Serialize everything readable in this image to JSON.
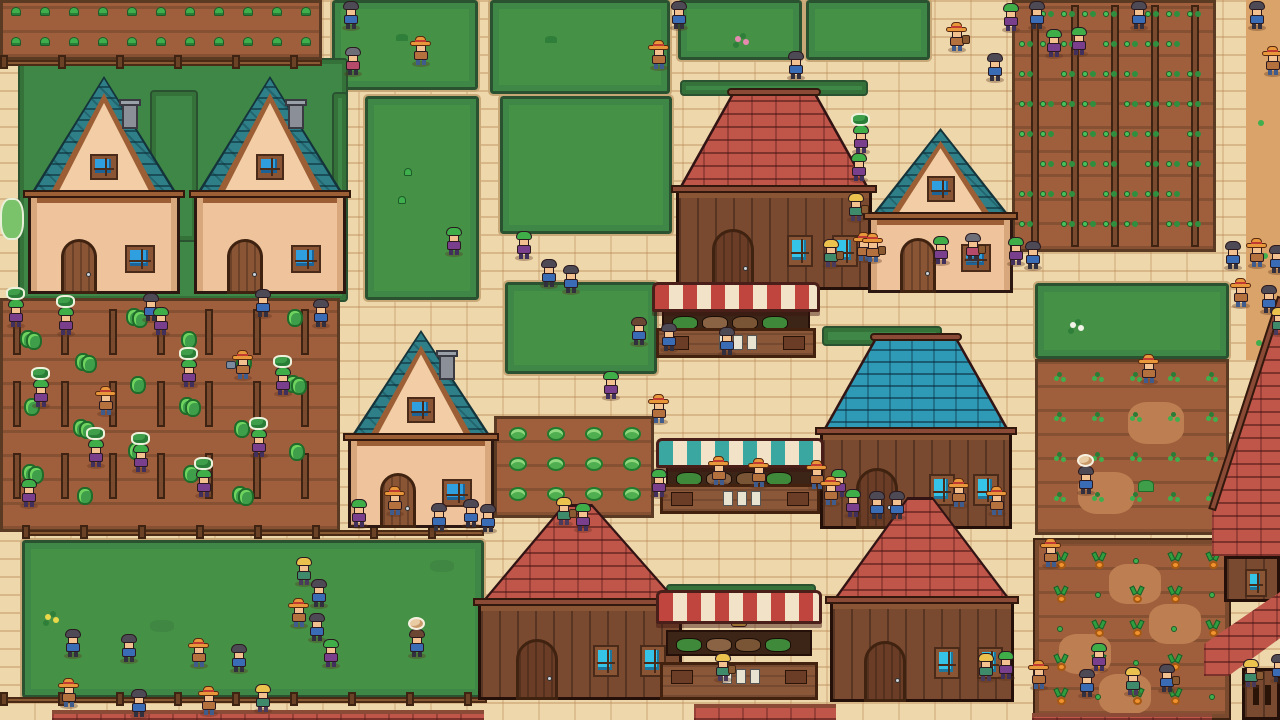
{
  "scene": {
    "width": 1280,
    "height": 720,
    "kind": "pixel-art-farming-village"
  },
  "palette": {
    "path": "#eed7ab",
    "path_line": "#d8b787",
    "dirt": "#d9a369",
    "grass": "#459247",
    "grass_edge": "#2a5230",
    "hedge": "#3f8746",
    "soil": "#a05f3c",
    "soil_light": "#bd7f52",
    "soil_border": "#5a3a22",
    "roof_teal": "#2e7f88",
    "roof_red": "#c0554a",
    "roof_blue": "#2f9ab5",
    "roof_trim": "#9c5f35",
    "ridge": "#8a4a35",
    "wall_peach": "#efc49c",
    "wall_wood": "#7a4a30",
    "door": "#8a5535",
    "door_dark": "#6b3d26",
    "glass_blue": "#2f9fe0",
    "glass_teal": "#35c4e8",
    "awning_red": "#c0453f",
    "awning_teal": "#3aa7a0",
    "awning_cream": "#f2e3c8",
    "stall_wood": "#8a5738",
    "stall_dark": "#3c2517",
    "fence": "#8a5a35",
    "fence_post": "#6b4226",
    "leaf": "#3fae4c",
    "leaf_dark": "#2a7d36",
    "carrot": "#f0922e",
    "chimney": "#8a8f98",
    "villagers": {
      "straw": {
        "hat": "#e8973a",
        "band": "#c23b32",
        "shirt": "#b5713d",
        "pants": "#3f5c8c"
      },
      "green": {
        "hair": "#3fae49",
        "shirt": "#7a3f8c",
        "pants": "#42305c"
      },
      "dark": {
        "hair": "#4e4a55",
        "shirt": "#3a6bb5",
        "pants": "#32303e"
      },
      "gray": {
        "hair": "#6e6e78",
        "shirt": "#b54a6b",
        "pants": "#32303e"
      },
      "blonde": {
        "hair": "#ecc24e",
        "shirt": "#3f8a6b",
        "pants": "#4a3a5c"
      },
      "brown": {
        "hair": "#6b4632",
        "shirt": "#3a6bb5",
        "pants": "#32303e"
      }
    }
  },
  "ground": {
    "dirt_strip": {
      "x": 1246,
      "y": 0,
      "w": 34,
      "h": 360
    },
    "dirt_dots": [
      [
        1258,
        120
      ],
      [
        1262,
        253
      ],
      [
        1256,
        340
      ]
    ]
  },
  "grass_plots": [
    {
      "x": 332,
      "y": 0,
      "w": 146,
      "h": 90
    },
    {
      "x": 490,
      "y": 0,
      "w": 180,
      "h": 94
    },
    {
      "x": 678,
      "y": 0,
      "w": 124,
      "h": 60
    },
    {
      "x": 806,
      "y": 0,
      "w": 124,
      "h": 60
    },
    {
      "x": 365,
      "y": 96,
      "w": 114,
      "h": 204
    },
    {
      "x": 500,
      "y": 96,
      "w": 172,
      "h": 138
    },
    {
      "x": 505,
      "y": 282,
      "w": 152,
      "h": 92
    },
    {
      "x": 22,
      "y": 540,
      "w": 462,
      "h": 158
    },
    {
      "x": 1035,
      "y": 283,
      "w": 194,
      "h": 76
    }
  ],
  "hedges": [
    {
      "x": 18,
      "y": 58,
      "w": 330,
      "h": 244
    },
    {
      "x": 150,
      "y": 90,
      "w": 48,
      "h": 152
    },
    {
      "x": 332,
      "y": 92,
      "w": 16,
      "h": 160
    },
    {
      "x": 680,
      "y": 80,
      "w": 188,
      "h": 16
    },
    {
      "x": 822,
      "y": 326,
      "w": 120,
      "h": 20
    },
    {
      "x": 666,
      "y": 584,
      "w": 150,
      "h": 26
    }
  ],
  "bushes": [
    {
      "x": 0,
      "y": 198,
      "w": 24,
      "h": 42
    }
  ],
  "fields": [
    {
      "type": "seedlings",
      "x": 0,
      "y": 0,
      "w": 322,
      "h": 60
    },
    {
      "type": "trellis",
      "x": 0,
      "y": 298,
      "w": 340,
      "h": 234
    },
    {
      "type": "beans",
      "x": 1012,
      "y": 0,
      "w": 204,
      "h": 252
    },
    {
      "type": "sprouts",
      "x": 1035,
      "y": 359,
      "w": 194,
      "h": 176
    },
    {
      "type": "carrots",
      "x": 1035,
      "y": 540,
      "w": 194,
      "h": 178
    },
    {
      "type": "cabbage",
      "x": 494,
      "y": 416,
      "w": 160,
      "h": 102
    }
  ],
  "fences": [
    {
      "x": 0,
      "y": 60,
      "w": 322
    },
    {
      "x": 22,
      "y": 530,
      "w": 462
    },
    {
      "x": 0,
      "y": 697,
      "w": 487
    }
  ],
  "roof_strips": [
    {
      "x": 52,
      "y": 710,
      "w": 432,
      "h": 10
    },
    {
      "x": 694,
      "y": 704,
      "w": 142,
      "h": 16
    },
    {
      "x": 1032,
      "y": 713,
      "w": 180,
      "h": 7
    }
  ],
  "buildings": [
    {
      "type": "house",
      "roof": "teal",
      "x": 28,
      "y": 76,
      "w": 152,
      "h": 218,
      "chimney": true
    },
    {
      "type": "house",
      "roof": "teal",
      "x": 194,
      "y": 76,
      "w": 152,
      "h": 218,
      "chimney": true
    },
    {
      "type": "barn",
      "roof": "red",
      "x": 676,
      "y": 88,
      "w": 196,
      "h": 202,
      "flat": true
    },
    {
      "type": "house",
      "roof": "teal",
      "x": 868,
      "y": 128,
      "w": 145,
      "h": 165,
      "chimney": false
    },
    {
      "type": "house",
      "roof": "teal",
      "x": 348,
      "y": 330,
      "w": 146,
      "h": 198,
      "chimney": true
    },
    {
      "type": "barn",
      "roof": "blue",
      "x": 820,
      "y": 333,
      "w": 192,
      "h": 196,
      "flat": true
    },
    {
      "type": "barn",
      "roof": "red",
      "x": 478,
      "y": 504,
      "w": 204,
      "h": 196,
      "flat": false
    },
    {
      "type": "barn",
      "roof": "red",
      "x": 830,
      "y": 497,
      "w": 184,
      "h": 205,
      "flat": false
    },
    {
      "type": "edge-right",
      "x": 1212,
      "y": 298,
      "w": 68,
      "h": 302
    },
    {
      "type": "edge-corner",
      "x": 1204,
      "y": 592,
      "w": 76,
      "h": 128
    }
  ],
  "stalls": [
    {
      "x": 656,
      "y": 282,
      "w": 160,
      "h": 76,
      "awning": "red",
      "keeper": "straw"
    },
    {
      "x": 660,
      "y": 438,
      "w": 160,
      "h": 76,
      "awning": "teal",
      "keeper": "blonde"
    },
    {
      "x": 660,
      "y": 590,
      "w": 158,
      "h": 110,
      "awning": "red",
      "keeper": "blonde"
    }
  ],
  "decor": [
    {
      "x": 396,
      "y": 34,
      "k": "tuft"
    },
    {
      "x": 735,
      "y": 36,
      "k": "flower-pink"
    },
    {
      "x": 404,
      "y": 168,
      "k": "sprout"
    },
    {
      "x": 398,
      "y": 196,
      "k": "sprout"
    },
    {
      "x": 545,
      "y": 36,
      "k": "tuft"
    },
    {
      "x": 45,
      "y": 614,
      "k": "flower-yellow"
    },
    {
      "x": 150,
      "y": 620,
      "k": "patch"
    },
    {
      "x": 430,
      "y": 560,
      "k": "patch"
    },
    {
      "x": 1070,
      "y": 322,
      "k": "flower-white"
    }
  ],
  "villagers": [
    [
      340,
      0,
      "dark"
    ],
    [
      342,
      46,
      "gray"
    ],
    [
      410,
      36,
      "straw"
    ],
    [
      648,
      40,
      "straw"
    ],
    [
      668,
      0,
      "dark"
    ],
    [
      785,
      50,
      "dark"
    ],
    [
      946,
      22,
      "straw",
      "basket"
    ],
    [
      984,
      52,
      "dark"
    ],
    [
      1000,
      2,
      "green"
    ],
    [
      1026,
      0,
      "dark"
    ],
    [
      1043,
      28,
      "green"
    ],
    [
      1068,
      26,
      "green"
    ],
    [
      1128,
      0,
      "dark"
    ],
    [
      1246,
      0,
      "dark"
    ],
    [
      850,
      124,
      "green",
      "hops"
    ],
    [
      848,
      152,
      "green"
    ],
    [
      845,
      192,
      "blonde",
      "basket"
    ],
    [
      853,
      232,
      "straw"
    ],
    [
      820,
      238,
      "blonde",
      "basket"
    ],
    [
      862,
      233,
      "straw",
      "basket"
    ],
    [
      930,
      235,
      "green"
    ],
    [
      962,
      232,
      "gray",
      "basket"
    ],
    [
      1005,
      236,
      "green"
    ],
    [
      1022,
      240,
      "dark"
    ],
    [
      1262,
      46,
      "straw"
    ],
    [
      1222,
      240,
      "dark"
    ],
    [
      1246,
      238,
      "straw"
    ],
    [
      1266,
      244,
      "dark"
    ],
    [
      1230,
      278,
      "straw"
    ],
    [
      1258,
      284,
      "dark"
    ],
    [
      1268,
      306,
      "blonde"
    ],
    [
      443,
      226,
      "green"
    ],
    [
      513,
      230,
      "green"
    ],
    [
      538,
      258,
      "dark"
    ],
    [
      560,
      264,
      "dark"
    ],
    [
      628,
      316,
      "brown"
    ],
    [
      658,
      322,
      "dark"
    ],
    [
      716,
      326,
      "dark"
    ],
    [
      600,
      370,
      "green"
    ],
    [
      648,
      394,
      "straw"
    ],
    [
      648,
      468,
      "green"
    ],
    [
      708,
      456,
      "straw"
    ],
    [
      748,
      458,
      "straw"
    ],
    [
      806,
      460,
      "straw"
    ],
    [
      828,
      468,
      "green"
    ],
    [
      820,
      476,
      "straw"
    ],
    [
      842,
      488,
      "green"
    ],
    [
      866,
      490,
      "dark"
    ],
    [
      886,
      490,
      "dark"
    ],
    [
      948,
      478,
      "straw"
    ],
    [
      986,
      486,
      "straw"
    ],
    [
      5,
      298,
      "green",
      "hops"
    ],
    [
      55,
      306,
      "green",
      "hops"
    ],
    [
      140,
      292,
      "dark"
    ],
    [
      252,
      288,
      "dark"
    ],
    [
      150,
      306,
      "green"
    ],
    [
      30,
      378,
      "green",
      "hops"
    ],
    [
      95,
      386,
      "straw"
    ],
    [
      178,
      358,
      "green",
      "hops"
    ],
    [
      232,
      350,
      "straw",
      "can"
    ],
    [
      272,
      366,
      "green",
      "hops"
    ],
    [
      85,
      438,
      "green",
      "hops"
    ],
    [
      130,
      443,
      "green",
      "hops"
    ],
    [
      193,
      468,
      "green",
      "hops"
    ],
    [
      248,
      428,
      "green",
      "hops"
    ],
    [
      18,
      478,
      "green"
    ],
    [
      310,
      298,
      "dark"
    ],
    [
      62,
      628,
      "dark"
    ],
    [
      118,
      633,
      "dark"
    ],
    [
      188,
      638,
      "straw"
    ],
    [
      228,
      643,
      "dark"
    ],
    [
      58,
      678,
      "straw"
    ],
    [
      128,
      688,
      "dark"
    ],
    [
      198,
      686,
      "straw"
    ],
    [
      252,
      683,
      "blonde"
    ],
    [
      293,
      556,
      "blonde"
    ],
    [
      308,
      578,
      "dark"
    ],
    [
      288,
      598,
      "straw"
    ],
    [
      306,
      612,
      "dark"
    ],
    [
      320,
      638,
      "green"
    ],
    [
      406,
      628,
      "brown",
      "onion"
    ],
    [
      1075,
      465,
      "dark",
      "onion"
    ],
    [
      348,
      498,
      "green"
    ],
    [
      384,
      486,
      "straw"
    ],
    [
      428,
      502,
      "dark"
    ],
    [
      460,
      498,
      "dark"
    ],
    [
      477,
      503,
      "dark"
    ],
    [
      553,
      496,
      "blonde",
      "basket"
    ],
    [
      572,
      502,
      "green"
    ],
    [
      712,
      652,
      "blonde",
      "basket"
    ],
    [
      1138,
      354,
      "straw"
    ],
    [
      1040,
      538,
      "straw"
    ],
    [
      1088,
      642,
      "green"
    ],
    [
      1028,
      660,
      "straw"
    ],
    [
      1076,
      668,
      "dark"
    ],
    [
      1122,
      666,
      "blonde"
    ],
    [
      1156,
      663,
      "dark",
      "basket"
    ],
    [
      1240,
      658,
      "blonde",
      "basket"
    ],
    [
      1268,
      653,
      "dark"
    ],
    [
      975,
      652,
      "blonde"
    ],
    [
      995,
      650,
      "green"
    ]
  ]
}
